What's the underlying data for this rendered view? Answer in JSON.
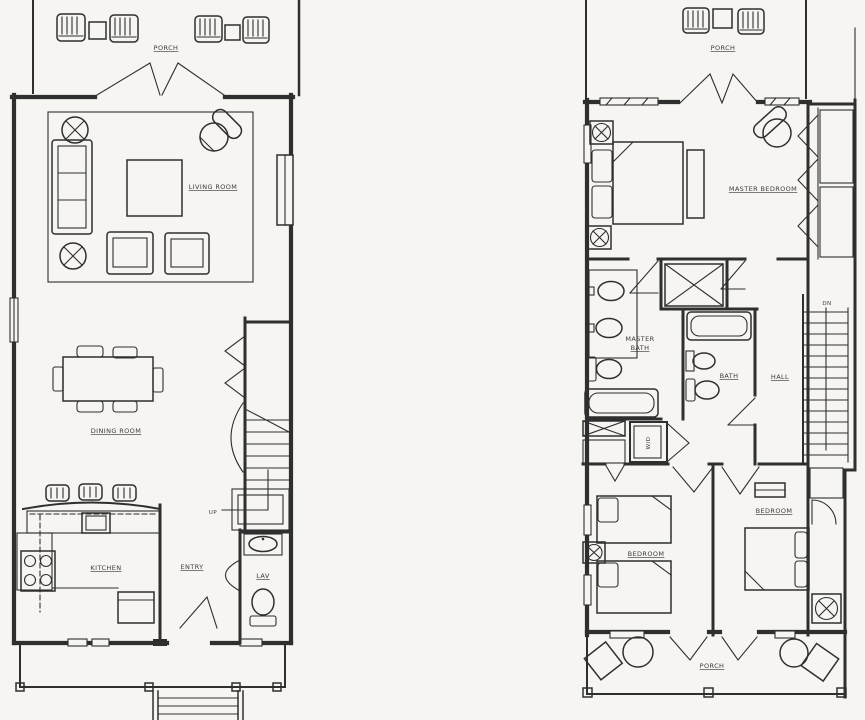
{
  "canvas": {
    "paper_color": "#f6f5f1",
    "ink_color": "#2f2f2f",
    "label_color": "#3a3a3a",
    "description": "Two hand-drafted architectural floor plans side by side"
  },
  "first_floor": {
    "name": "first-floor-plan",
    "labels": {
      "porch": "PORCH",
      "living_room": "LIVING ROOM",
      "dining_room": "DINING ROOM",
      "kitchen": "KITCHEN",
      "entry": "ENTRY",
      "lav": "LAV",
      "stairs": "UP"
    }
  },
  "second_floor": {
    "name": "second-floor-plan",
    "labels": {
      "porch_upper": "PORCH",
      "master_bedroom": "MASTER BEDROOM",
      "master_bath_line1": "MASTER",
      "master_bath_line2": "BATH",
      "bath": "BATH",
      "hall": "HALL",
      "stairs": "DN",
      "washer_dryer": "W/D",
      "bedroom_left": "BEDROOM",
      "bedroom_right": "BEDROOM",
      "porch_lower": "PORCH"
    }
  }
}
